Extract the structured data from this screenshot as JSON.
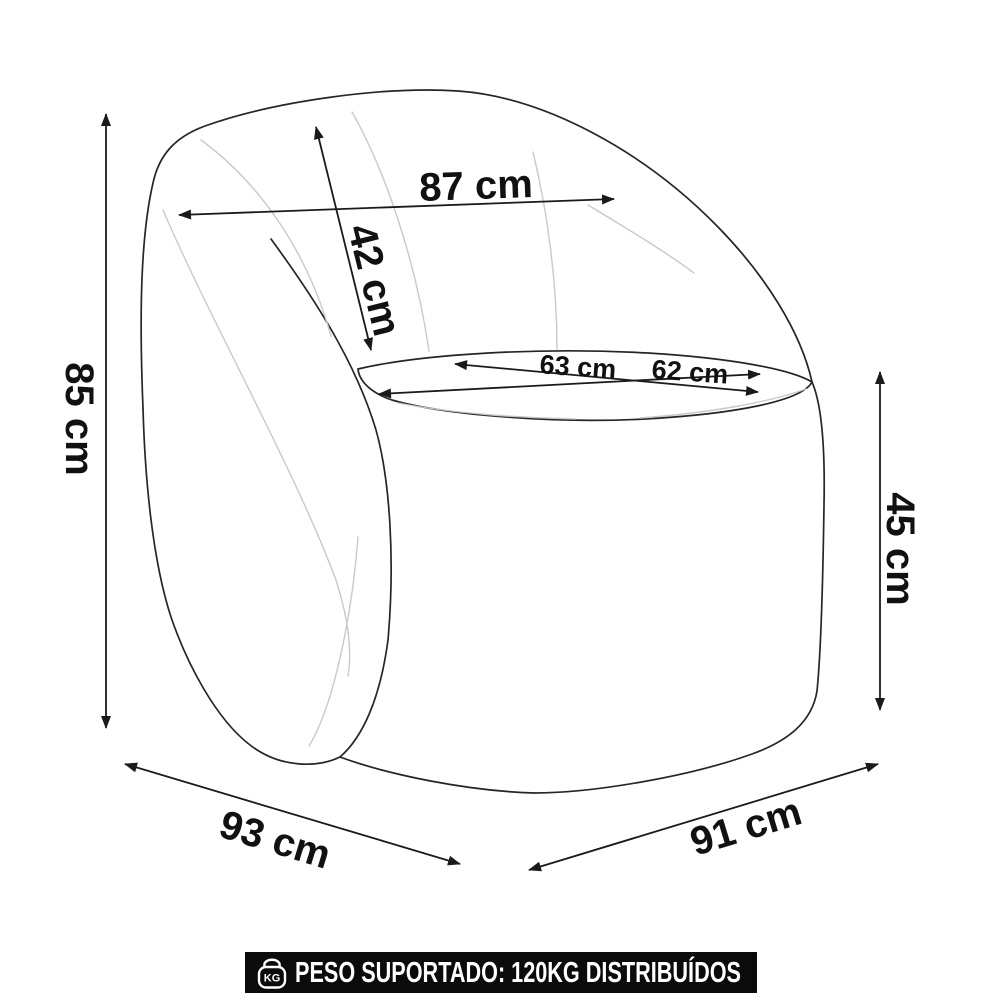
{
  "diagram": {
    "subject": "armchair-dimension-drawing",
    "line_color": "#262626",
    "seam_color": "#c9c9c9",
    "label_color": "#111111",
    "labels": {
      "back_width": "87 cm",
      "backrest_height": "42 cm",
      "total_height": "85 cm",
      "seat_depth": "63 cm",
      "seat_width": "62 cm",
      "seat_height": "45 cm",
      "total_depth": "93 cm",
      "total_width": "91 cm"
    }
  },
  "footer": {
    "icon": "kg-weight-icon",
    "icon_text": "KG",
    "text": "PESO SUPORTADO: 120KG DISTRIBUÍDOS",
    "bg_color": "#0b0b0b",
    "text_color": "#ffffff"
  }
}
